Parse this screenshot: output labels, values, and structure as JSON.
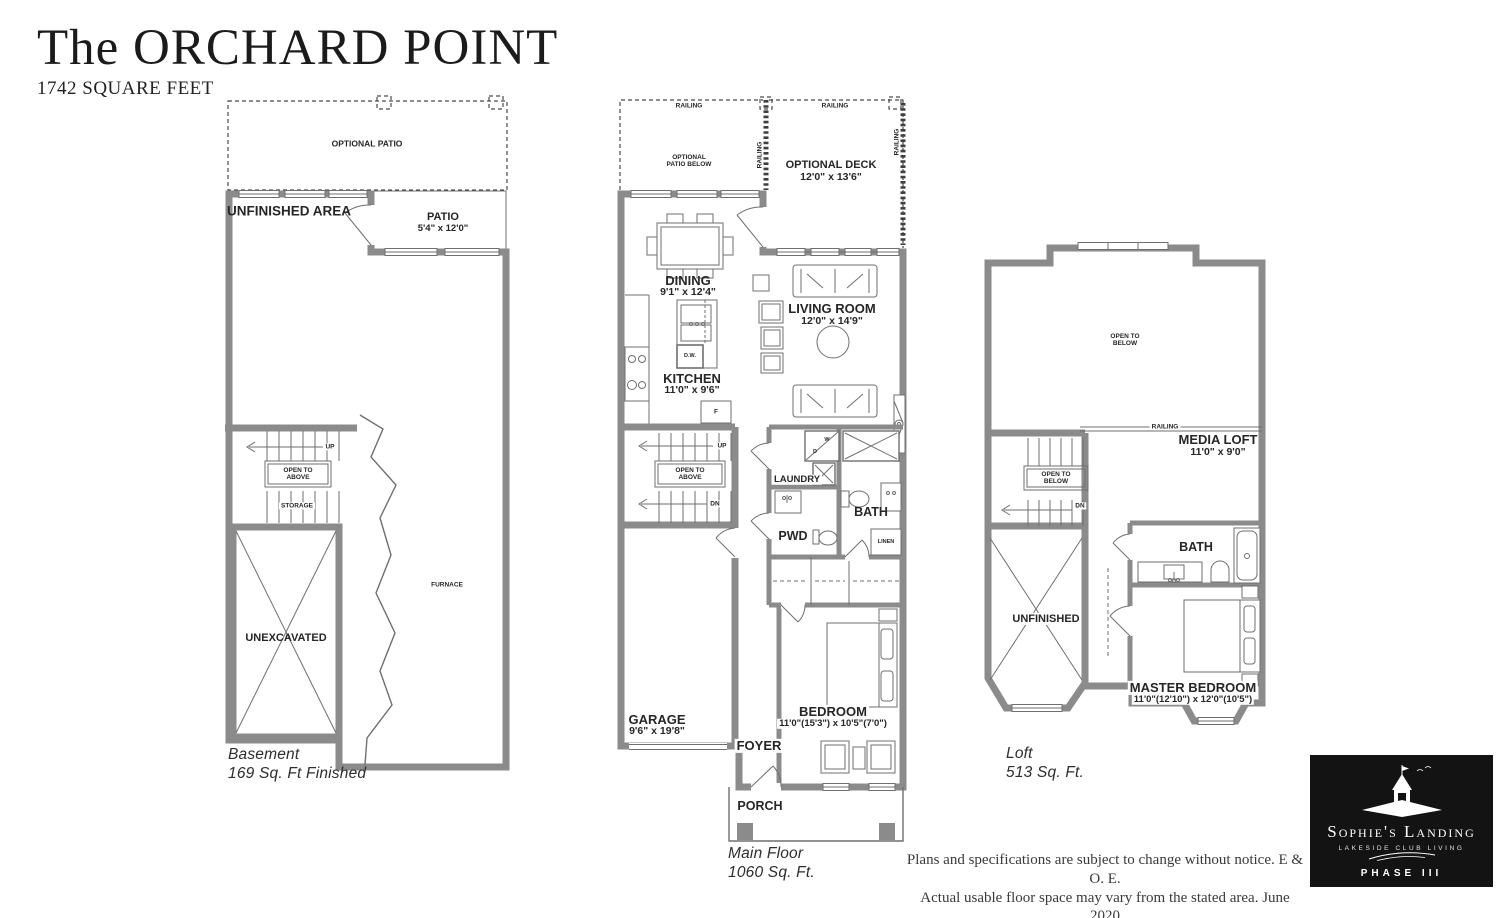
{
  "page": {
    "title_line": "The ORCHARD POINT",
    "subtitle": "1742 SQUARE FEET"
  },
  "basement": {
    "floor_label": "Basement",
    "floor_area": "169 Sq. Ft Finished",
    "labels": {
      "optional_patio": "OPTIONAL PATIO",
      "unfinished_area": "UNFINISHED AREA",
      "patio": "PATIO",
      "patio_dim": "5'4\" x 12'0\"",
      "up": "UP",
      "open_to_above": "OPEN TO ABOVE",
      "storage": "STORAGE",
      "unexcavated": "UNEXCAVATED",
      "furnace": "FURNACE"
    }
  },
  "main_floor": {
    "floor_label": "Main Floor",
    "floor_area": "1060 Sq. Ft.",
    "labels": {
      "railing": "RAILING",
      "optional_patio_below": "OPTIONAL PATIO BELOW",
      "optional_deck": "OPTIONAL DECK",
      "optional_deck_dim": "12'0\" x 13'6\"",
      "dining": "DINING",
      "dining_dim": "9'1\" x 12'4\"",
      "living_room": "LIVING ROOM",
      "living_room_dim": "12'0\" x 14'9\"",
      "kitchen": "KITCHEN",
      "kitchen_dim": "11'0\" x 9'6\"",
      "dishwasher": "D.W.",
      "fridge": "F",
      "up": "UP",
      "dn": "DN",
      "open_to_above": "OPEN TO ABOVE",
      "laundry": "LAUNDRY",
      "washer": "W",
      "dryer": "D",
      "bath": "BATH",
      "pwd": "PWD",
      "linen": "LINEN",
      "garage": "GARAGE",
      "garage_dim": "9'6\" x 19'8\"",
      "foyer": "FOYER",
      "bedroom": "BEDROOM",
      "bedroom_dim": "11'0\"(15'3\") x 10'5\"(7'0\")",
      "porch": "PORCH"
    }
  },
  "loft": {
    "floor_label": "Loft",
    "floor_area": "513 Sq. Ft.",
    "labels": {
      "open_to_below": "OPEN TO BELOW",
      "railing": "RAILING",
      "media_loft": "MEDIA LOFT",
      "media_loft_dim": "11'0\" x 9'0\"",
      "dn": "DN",
      "unfinished": "UNFINISHED",
      "bath": "BATH",
      "master_bedroom": "MASTER BEDROOM",
      "master_bedroom_dim": "11'0\"(12'10\") x 12'0\"(10'5\")"
    }
  },
  "footer": {
    "disclaimer_line1": "Plans and specifications are subject to change without notice. E & O. E.",
    "disclaimer_line2": "Actual usable floor space may vary from the stated area. June 2020"
  },
  "logo": {
    "brand": "Sophie's Landing",
    "tagline": "LAKESIDE CLUB LIVING",
    "phase": "PHASE III"
  },
  "colors": {
    "wall_gray": "#8b8b8b",
    "line_gray": "#6f6f6f",
    "text_dark": "#262626",
    "logo_bg": "#131313",
    "logo_text": "#ffffff"
  }
}
